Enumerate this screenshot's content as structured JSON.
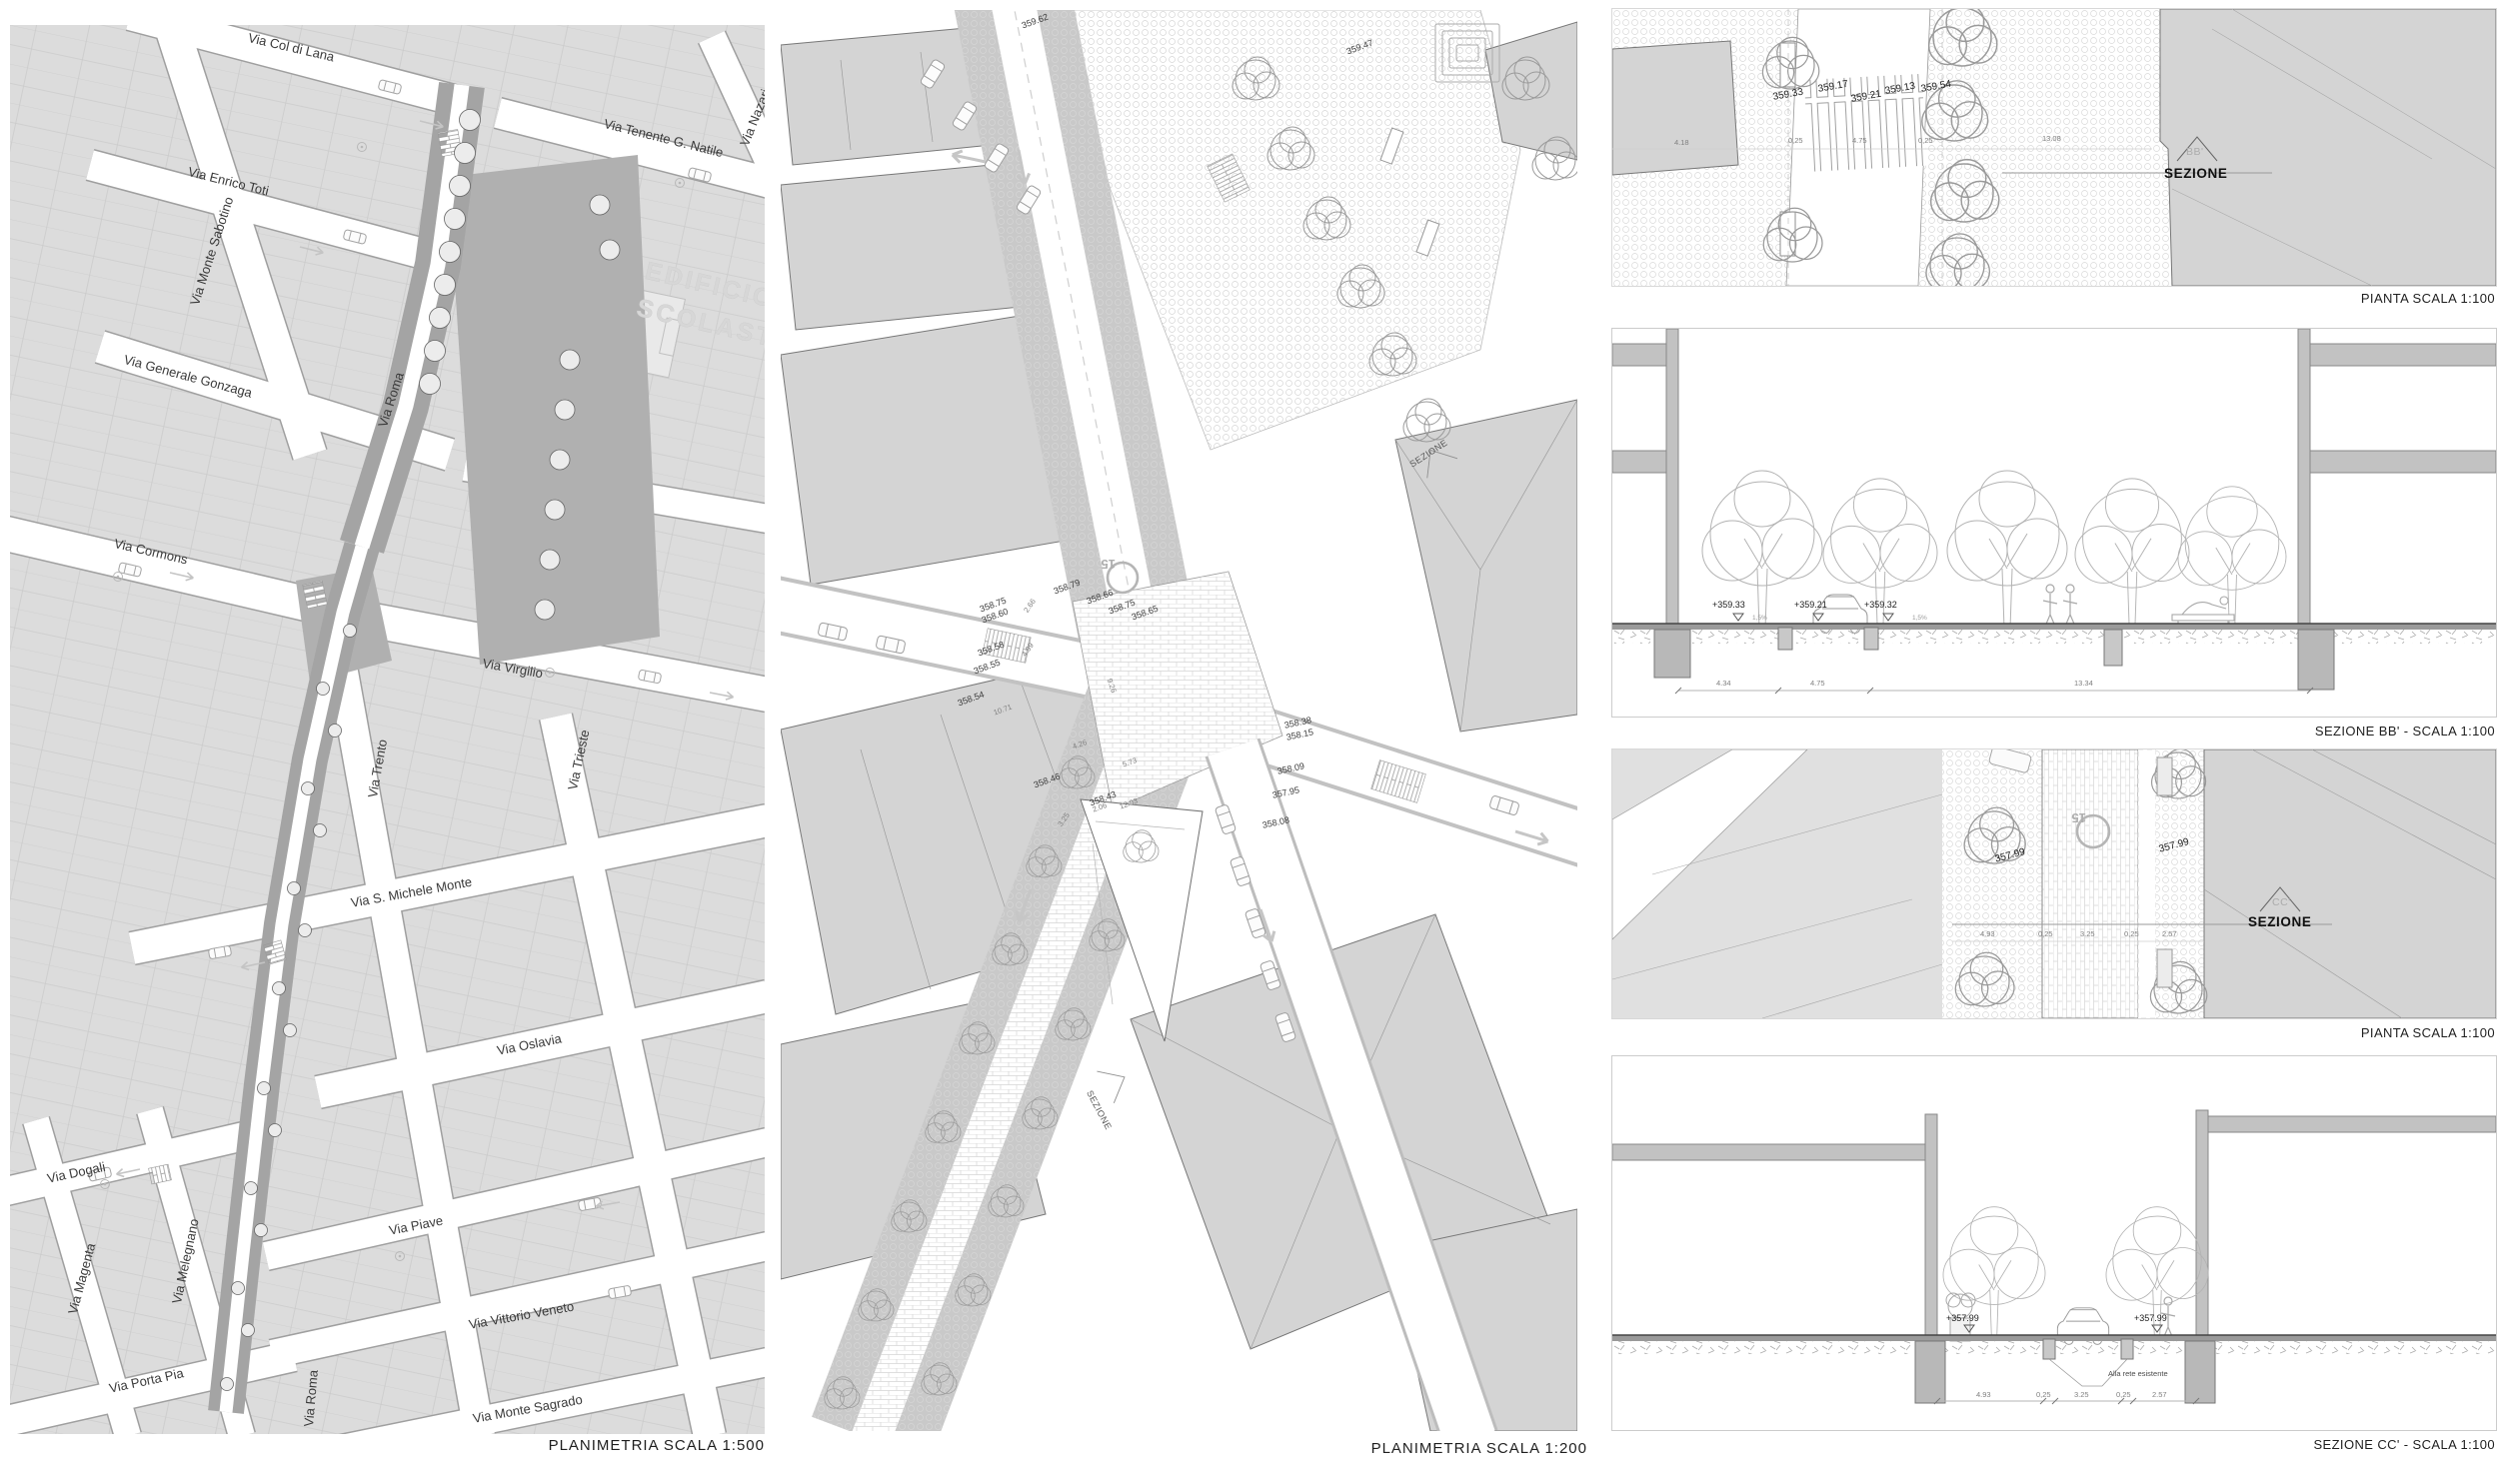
{
  "plan500": {
    "caption": "PLANIMETRIA  SCALA 1:500",
    "building_label": "EDIFICIO SCOLASTICO",
    "streets": {
      "col_di_lana": "Via Col di Lana",
      "monte_sabotino": "Via Monte Sabotino",
      "nazario_sauro": "Via Nazario Sauro",
      "tenente_natile": "Via Tenente G. Natile",
      "enrico_toti": "Via Enrico Toti",
      "generale_gonzaga": "Via Generale Gonzaga",
      "roma": "Via Roma",
      "cormons": "Via Cormons",
      "virgilio": "Via Virgilio",
      "trento": "Via Trento",
      "trieste": "Via Trieste",
      "s_michele_monte": "Via S. Michele Monte",
      "oslavia": "Via Oslavia",
      "dogali": "Via Dogali",
      "magenta": "Via Magenta",
      "melegnano": "Via Melegnano",
      "piave": "Via Piave",
      "vittorio_veneto": "Via Vittorio Veneto",
      "porta_pia": "Via Porta Pia",
      "monte_sagrado": "Via Monte Sagrado",
      "roma_sud": "Via Roma"
    }
  },
  "plan200": {
    "caption": "PLANIMETRIA  SCALA 1:200",
    "zone_badge": "15",
    "sezione_label": "SEZIONE",
    "spots": {
      "e_top1": "359.62",
      "e_top2": "359.47",
      "e1": "358.79",
      "e2": "358.66",
      "e3": "358.75",
      "e4": "358.65",
      "e5": "358.75",
      "e6": "358.60",
      "e7": "358.58",
      "e8": "358.55",
      "e9": "358.54",
      "e10": "358.46",
      "e11": "358.43",
      "e12": "358.38",
      "e13": "358.15",
      "e14": "358.09",
      "e15": "357.95",
      "e16": "358.08"
    },
    "dims": {
      "d1": "2.66",
      "d2": "4.99",
      "d3": "10.71",
      "d4": "4.26",
      "d5": "5.73",
      "d6": "12.93",
      "d7": "2.06",
      "d8": "3.25",
      "d9": "9.26"
    }
  },
  "pianta_bb": {
    "caption": "PIANTA  SCALA 1:100",
    "marker": "BB'",
    "sezione_label": "SEZIONE",
    "elevations": {
      "e1": "359.33",
      "e2": "359.17",
      "e3": "359.21",
      "e4": "359.13",
      "e5": "359.54"
    },
    "dims": {
      "d1": "4.18",
      "d2": "0,25",
      "d3": "4.75",
      "d4": "0,25",
      "d5": "13.08"
    }
  },
  "sezione_bb": {
    "caption": "SEZIONE BB' - SCALA 1:100",
    "elevations": {
      "e1": "+359.33",
      "e2": "+359.21",
      "e3": "+359.32"
    },
    "slopes": {
      "s1": "1,5%",
      "s2": "1,5%"
    },
    "dims": {
      "d1": "4.34",
      "d2": "4.75",
      "d3": "13.34"
    }
  },
  "pianta_cc": {
    "caption": "PIANTA  SCALA 1:100",
    "marker": "CC'",
    "sezione_label": "SEZIONE",
    "zone_badge": "15",
    "elevations": {
      "e1": "357.99",
      "e2": "357.99"
    },
    "dims": {
      "d1": "4.93",
      "d2": "0,25",
      "d3": "3.25",
      "d4": "0,25",
      "d5": "2.57"
    }
  },
  "sezione_cc": {
    "caption": "SEZIONE CC' - SCALA 1:100",
    "note": "Alla rete esistente",
    "elevations": {
      "e1": "+357.99",
      "e2": "+357.99"
    },
    "dims": {
      "d1": "4.93",
      "d2": "0,25",
      "d3": "3.25",
      "d4": "0,25",
      "d5": "2.57"
    }
  }
}
